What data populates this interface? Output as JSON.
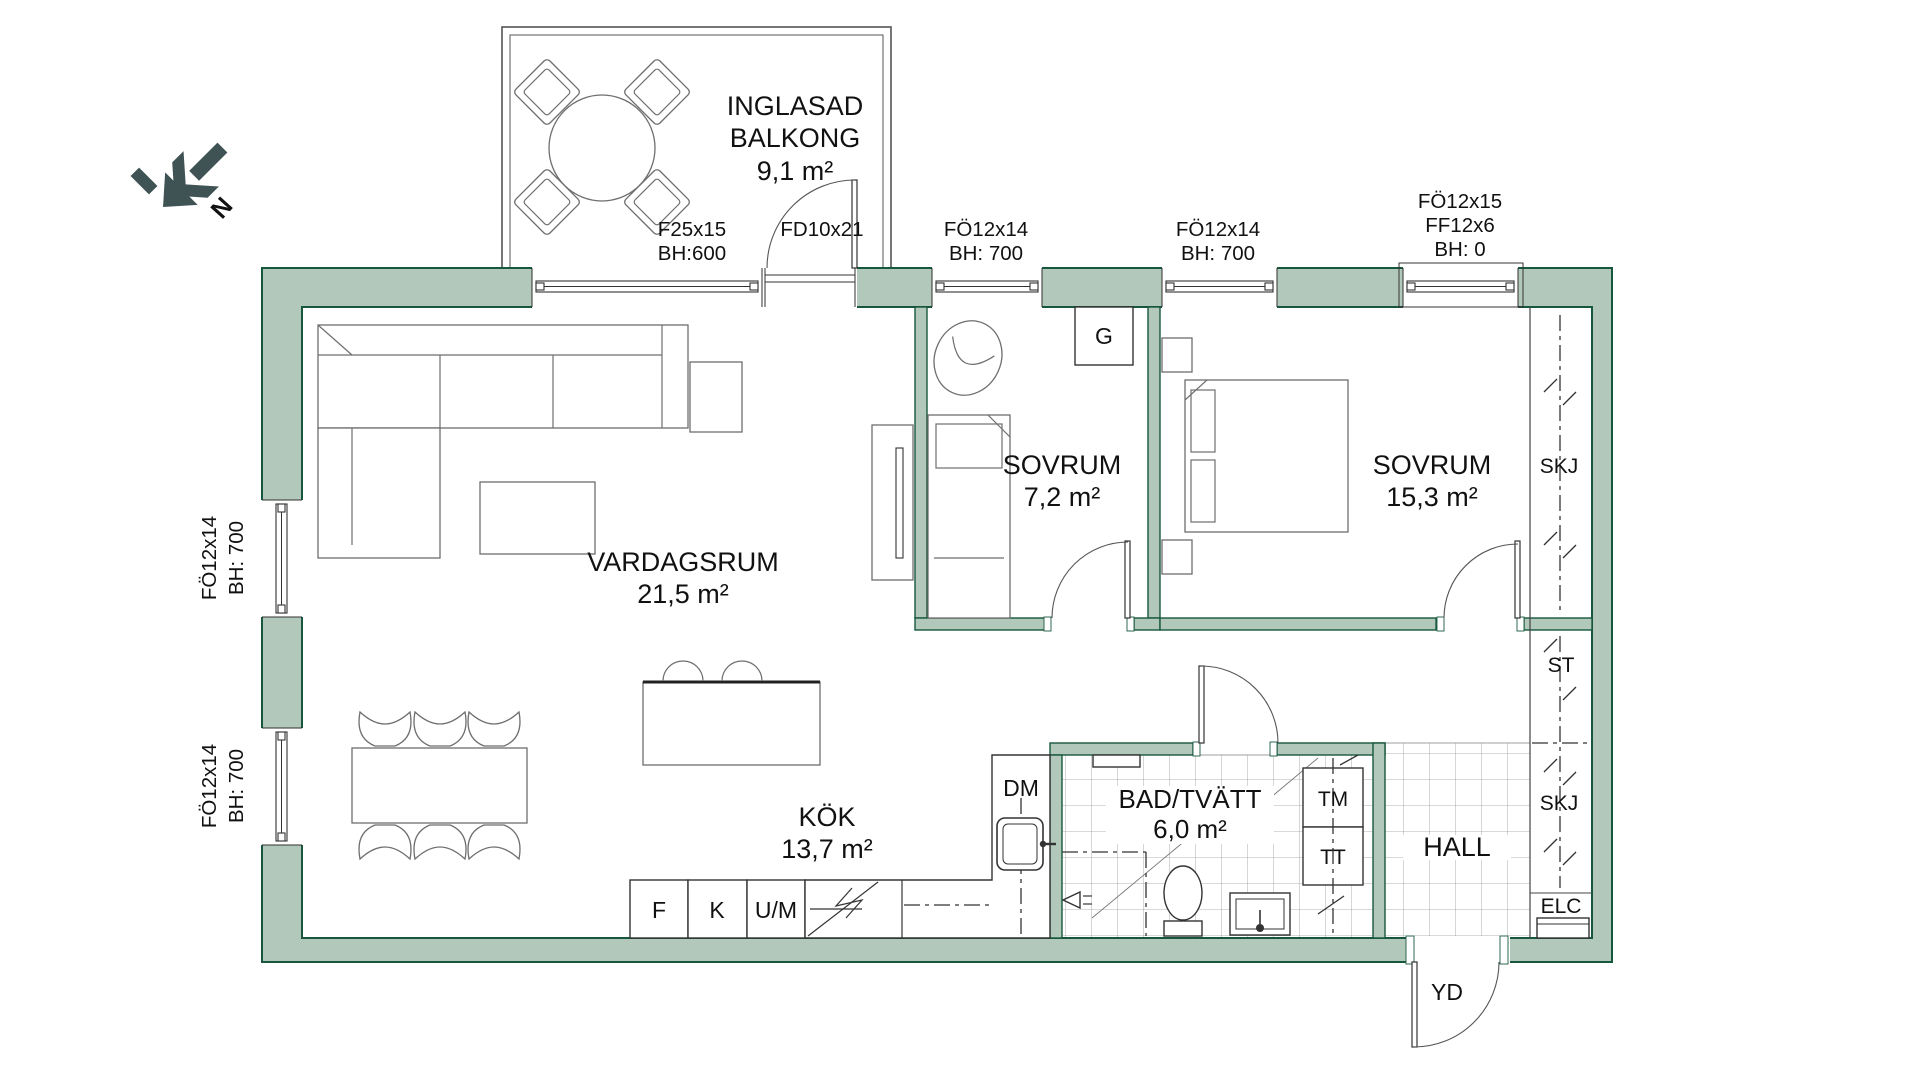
{
  "colors": {
    "wall_fill": "#b2c8ba",
    "wall_stroke": "#17573e",
    "compass": "#3f5355",
    "furniture_line": "#6e6e6e",
    "tile_line": "#999999",
    "text": "#111111"
  },
  "compass": {
    "label": "N"
  },
  "rooms": {
    "balcony": {
      "line1": "INGLASAD",
      "line2": "BALKONG",
      "area": "9,1 m²"
    },
    "living": {
      "name": "VARDAGSRUM",
      "area": "21,5 m²"
    },
    "bedroom1": {
      "name": "SOVRUM",
      "area": "7,2 m²"
    },
    "bedroom2": {
      "name": "SOVRUM",
      "area": "15,3 m²"
    },
    "kitchen": {
      "name": "KÖK",
      "area": "13,7 m²"
    },
    "bath": {
      "name": "BAD/TVÄTT",
      "area": "6,0 m²"
    },
    "hall": {
      "name": "HALL"
    }
  },
  "openings": {
    "balcony_window": {
      "l1": "F25x15",
      "l2": "BH:600"
    },
    "balcony_door": {
      "l1": "FD10x21"
    },
    "top_window_1": {
      "l1": "FÖ12x14",
      "l2": "BH: 700"
    },
    "top_window_2": {
      "l1": "FÖ12x14",
      "l2": "BH: 700"
    },
    "top_window_3": {
      "l1": "FÖ12x15",
      "l2": "FF12x6",
      "l3": "BH: 0"
    },
    "left_window_1": {
      "l1": "FÖ12x14",
      "l2": "BH: 700"
    },
    "left_window_2": {
      "l1": "FÖ12x14",
      "l2": "BH: 700"
    },
    "entry_door": {
      "label": "YD"
    }
  },
  "fixtures": {
    "wardrobe": "G",
    "dishwasher": "DM",
    "freezer": "F",
    "fridge": "K",
    "oven_micro": "U/M",
    "washer": "TM",
    "dryer": "TT",
    "skj_bedroom": "SKJ",
    "cleaning": "ST",
    "skj_hall": "SKJ",
    "electrical": "ELC"
  }
}
